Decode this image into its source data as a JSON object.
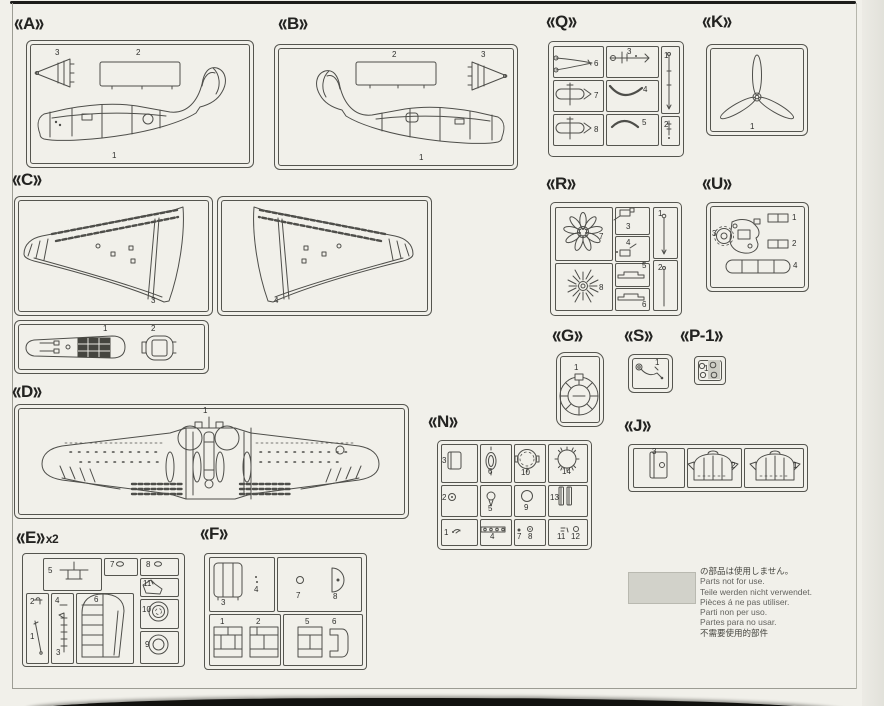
{
  "document": {
    "kind": "model kit parts map",
    "section_count": 15
  },
  "sections": [
    {
      "id": "A",
      "label": "A",
      "x": 14,
      "y": 14,
      "suffix": ""
    },
    {
      "id": "B",
      "label": "B",
      "x": 278,
      "y": 14,
      "suffix": ""
    },
    {
      "id": "Q",
      "label": "Q",
      "x": 546,
      "y": 12,
      "suffix": ""
    },
    {
      "id": "K",
      "label": "K",
      "x": 702,
      "y": 12,
      "suffix": ""
    },
    {
      "id": "C",
      "label": "C",
      "x": 12,
      "y": 170,
      "suffix": ""
    },
    {
      "id": "R",
      "label": "R",
      "x": 546,
      "y": 174,
      "suffix": ""
    },
    {
      "id": "U",
      "label": "U",
      "x": 702,
      "y": 174,
      "suffix": ""
    },
    {
      "id": "G",
      "label": "G",
      "x": 552,
      "y": 326,
      "suffix": ""
    },
    {
      "id": "S",
      "label": "S",
      "x": 624,
      "y": 326,
      "suffix": ""
    },
    {
      "id": "P-1",
      "label": "P-1",
      "x": 680,
      "y": 326,
      "suffix": ""
    },
    {
      "id": "D",
      "label": "D",
      "x": 12,
      "y": 382,
      "suffix": ""
    },
    {
      "id": "N",
      "label": "N",
      "x": 428,
      "y": 412,
      "suffix": ""
    },
    {
      "id": "J",
      "label": "J",
      "x": 624,
      "y": 416,
      "suffix": ""
    },
    {
      "id": "E",
      "label": "E",
      "x": 16,
      "y": 528,
      "suffix": "x2"
    },
    {
      "id": "F",
      "label": "F",
      "x": 200,
      "y": 524,
      "suffix": ""
    }
  ],
  "part_labels": [
    {
      "s": "A",
      "n": "3",
      "x": 55,
      "y": 49
    },
    {
      "s": "A",
      "n": "2",
      "x": 136,
      "y": 49
    },
    {
      "s": "A",
      "n": "1",
      "x": 112,
      "y": 152
    },
    {
      "s": "B",
      "n": "2",
      "x": 392,
      "y": 51
    },
    {
      "s": "B",
      "n": "3",
      "x": 481,
      "y": 51
    },
    {
      "s": "B",
      "n": "1",
      "x": 419,
      "y": 154
    },
    {
      "s": "Q",
      "n": "6",
      "x": 594,
      "y": 60
    },
    {
      "s": "Q",
      "n": "3",
      "x": 627,
      "y": 48
    },
    {
      "s": "Q",
      "n": "1",
      "x": 664,
      "y": 52
    },
    {
      "s": "Q",
      "n": "7",
      "x": 594,
      "y": 92
    },
    {
      "s": "Q",
      "n": "4",
      "x": 643,
      "y": 86
    },
    {
      "s": "Q",
      "n": "8",
      "x": 594,
      "y": 126
    },
    {
      "s": "Q",
      "n": "5",
      "x": 642,
      "y": 119
    },
    {
      "s": "Q",
      "n": "2",
      "x": 664,
      "y": 121
    },
    {
      "s": "K",
      "n": "1",
      "x": 750,
      "y": 123
    },
    {
      "s": "C",
      "n": "3",
      "x": 151,
      "y": 297
    },
    {
      "s": "C",
      "n": "4",
      "x": 274,
      "y": 297
    },
    {
      "s": "C",
      "n": "1",
      "x": 103,
      "y": 325
    },
    {
      "s": "C",
      "n": "2",
      "x": 151,
      "y": 325
    },
    {
      "s": "R",
      "n": "7",
      "x": 599,
      "y": 233
    },
    {
      "s": "R",
      "n": "3",
      "x": 626,
      "y": 223
    },
    {
      "s": "R",
      "n": "4",
      "x": 626,
      "y": 239
    },
    {
      "s": "R",
      "n": "5",
      "x": 642,
      "y": 262
    },
    {
      "s": "R",
      "n": "6",
      "x": 642,
      "y": 301
    },
    {
      "s": "R",
      "n": "1",
      "x": 658,
      "y": 210
    },
    {
      "s": "R",
      "n": "2",
      "x": 658,
      "y": 264
    },
    {
      "s": "R",
      "n": "8",
      "x": 599,
      "y": 284
    },
    {
      "s": "U",
      "n": "3",
      "x": 712,
      "y": 230
    },
    {
      "s": "U",
      "n": "1",
      "x": 792,
      "y": 214
    },
    {
      "s": "U",
      "n": "2",
      "x": 792,
      "y": 240
    },
    {
      "s": "U",
      "n": "4",
      "x": 793,
      "y": 262
    },
    {
      "s": "G",
      "n": "1",
      "x": 574,
      "y": 364
    },
    {
      "s": "S",
      "n": "1",
      "x": 655,
      "y": 359
    },
    {
      "s": "P-1",
      "n": "1",
      "x": 704,
      "y": 365
    },
    {
      "s": "D",
      "n": "1",
      "x": 203,
      "y": 407
    },
    {
      "s": "N",
      "n": "3",
      "x": 442,
      "y": 457
    },
    {
      "s": "N",
      "n": "6",
      "x": 488,
      "y": 468
    },
    {
      "s": "N",
      "n": "10",
      "x": 521,
      "y": 469
    },
    {
      "s": "N",
      "n": "14",
      "x": 562,
      "y": 468
    },
    {
      "s": "N",
      "n": "2",
      "x": 442,
      "y": 494
    },
    {
      "s": "N",
      "n": "5",
      "x": 488,
      "y": 505
    },
    {
      "s": "N",
      "n": "9",
      "x": 524,
      "y": 504
    },
    {
      "s": "N",
      "n": "13",
      "x": 550,
      "y": 494
    },
    {
      "s": "N",
      "n": "1",
      "x": 444,
      "y": 529
    },
    {
      "s": "N",
      "n": "4",
      "x": 490,
      "y": 533
    },
    {
      "s": "N",
      "n": "7",
      "x": 517,
      "y": 533
    },
    {
      "s": "N",
      "n": "8",
      "x": 528,
      "y": 533
    },
    {
      "s": "N",
      "n": "11",
      "x": 557,
      "y": 533
    },
    {
      "s": "N",
      "n": "12",
      "x": 571,
      "y": 533
    },
    {
      "s": "J",
      "n": "3",
      "x": 652,
      "y": 448
    },
    {
      "s": "J",
      "n": "2",
      "x": 731,
      "y": 462
    },
    {
      "s": "J",
      "n": "1",
      "x": 793,
      "y": 462
    },
    {
      "s": "E",
      "n": "5",
      "x": 48,
      "y": 567
    },
    {
      "s": "E",
      "n": "7",
      "x": 110,
      "y": 561
    },
    {
      "s": "E",
      "n": "8",
      "x": 146,
      "y": 561
    },
    {
      "s": "E",
      "n": "11",
      "x": 143,
      "y": 580
    },
    {
      "s": "E",
      "n": "10",
      "x": 142,
      "y": 606
    },
    {
      "s": "E",
      "n": "9",
      "x": 145,
      "y": 641
    },
    {
      "s": "E",
      "n": "2",
      "x": 30,
      "y": 598
    },
    {
      "s": "E",
      "n": "1",
      "x": 30,
      "y": 633
    },
    {
      "s": "E",
      "n": "4",
      "x": 55,
      "y": 597
    },
    {
      "s": "E",
      "n": "3",
      "x": 56,
      "y": 649
    },
    {
      "s": "E",
      "n": "6",
      "x": 94,
      "y": 596
    },
    {
      "s": "F",
      "n": "3",
      "x": 221,
      "y": 599
    },
    {
      "s": "F",
      "n": "4",
      "x": 254,
      "y": 586
    },
    {
      "s": "F",
      "n": "7",
      "x": 296,
      "y": 592
    },
    {
      "s": "F",
      "n": "8",
      "x": 333,
      "y": 593
    },
    {
      "s": "F",
      "n": "1",
      "x": 220,
      "y": 618
    },
    {
      "s": "F",
      "n": "2",
      "x": 256,
      "y": 618
    },
    {
      "s": "F",
      "n": "5",
      "x": 305,
      "y": 618
    },
    {
      "s": "F",
      "n": "6",
      "x": 332,
      "y": 618
    }
  ],
  "note": {
    "lines": [
      "の部品は使用しません。",
      "Parts not for use.",
      "Teile werden nicht verwendet.",
      "Pièces á ne pas utiliser.",
      "Parti non per uso.",
      "Partes para no usar.",
      "不需要使用的部件"
    ]
  },
  "colors": {
    "paper": "#f1f0ea",
    "line_art": "#4e4e4a",
    "box_border": "#55554f",
    "swatch_gray": "#d2d2ca",
    "page_edge_dark": "#12120f"
  }
}
